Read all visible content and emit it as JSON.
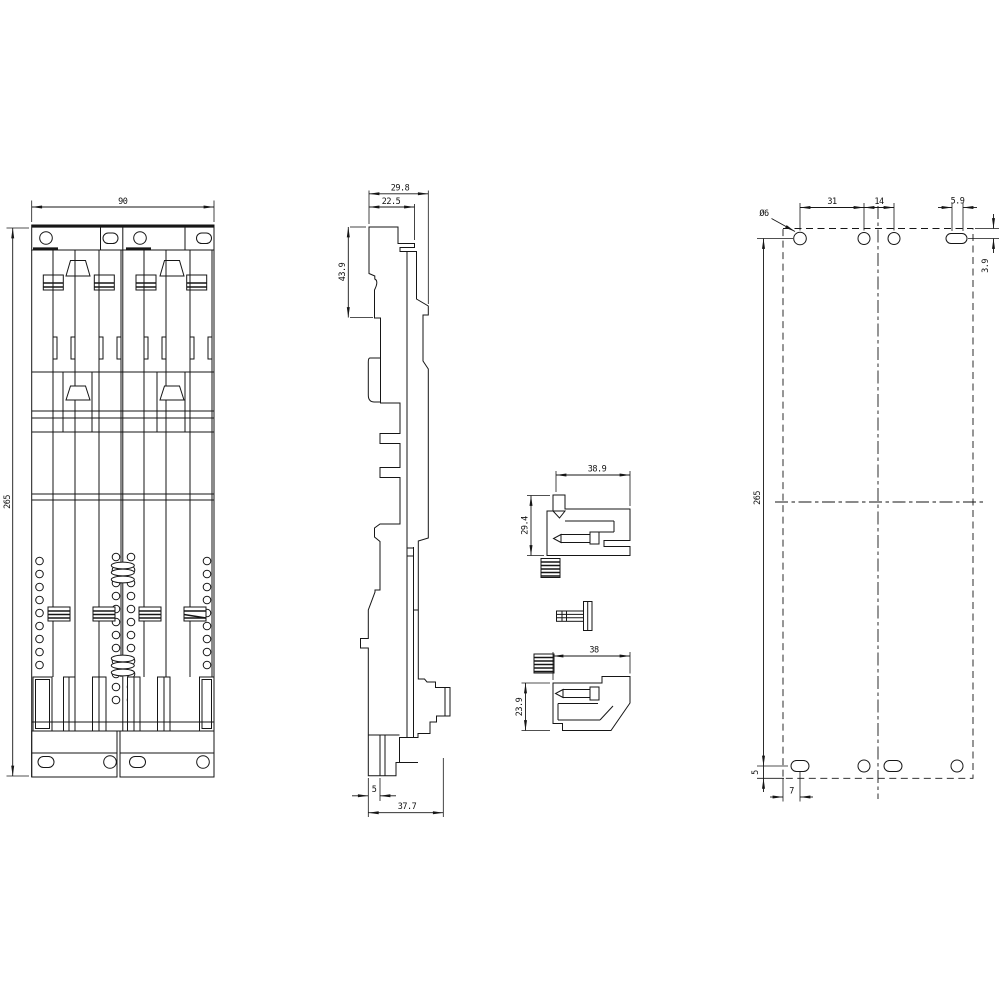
{
  "colors": {
    "background": "#ffffff",
    "line": "#161616"
  },
  "front_view": {
    "dim_width": "90",
    "dim_height": "265"
  },
  "side_view": {
    "dim_depth_total": "29.8",
    "dim_depth_upper": "22.5",
    "dim_upper_height": "43.9",
    "dim_foot_thickness": "5",
    "dim_foot_depth": "37.7"
  },
  "detail_upper_clip": {
    "dim_width": "38.9",
    "dim_height": "29.4"
  },
  "detail_lower_clip": {
    "dim_width": "38",
    "dim_height": "23.9"
  },
  "drilling_plan": {
    "dim_hole_diameter": "Ø6",
    "dim_hole_pitch_outer": "31",
    "dim_hole_pitch_inner": "14",
    "dim_slot_length": "5.9",
    "dim_top_edge_offset": "3.9",
    "dim_vertical_pitch": "265",
    "dim_bottom_edge_offset": "5",
    "dim_left_edge_offset": "7"
  }
}
